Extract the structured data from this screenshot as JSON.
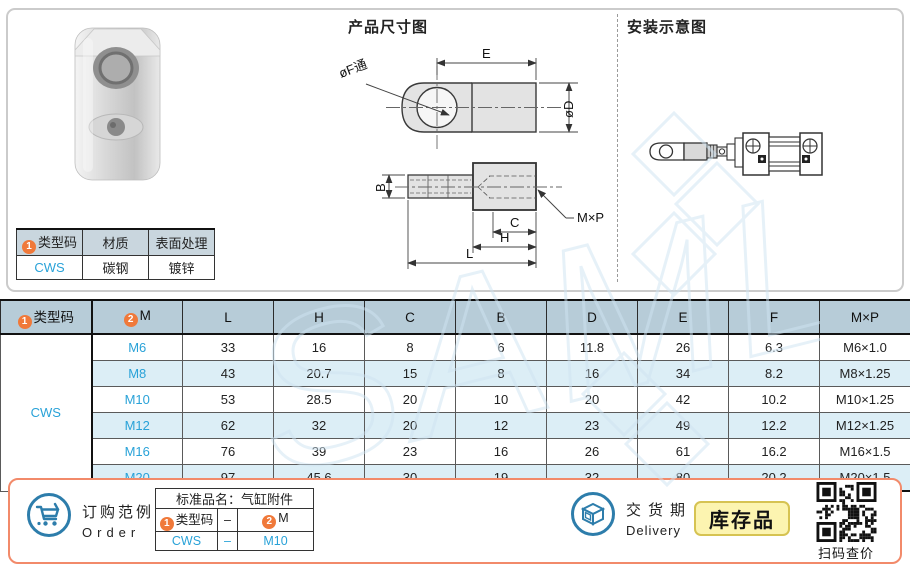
{
  "colors": {
    "accent_blue": "#2d7dab",
    "link_blue": "#29a2d8",
    "header_bg": "#b7ccd8",
    "row_alt_bg": "#dceef6",
    "marker_orange": "#f0793a",
    "panel_border": "#f28a6a",
    "badge_bg": "#fcf4b0",
    "watermark": "#cfe4f2"
  },
  "spec_table": {
    "headers": [
      {
        "marker": "1",
        "label": "类型码"
      },
      {
        "label": "材质"
      },
      {
        "label": "表面处理"
      }
    ],
    "row": [
      "CWS",
      "碳钢",
      "镀锌"
    ]
  },
  "drawings": {
    "dimension_title": "产品尺寸图",
    "install_title": "安装示意图",
    "labels": {
      "E": "E",
      "D": "øD",
      "F": "øF通",
      "B": "B",
      "C": "C",
      "H": "H",
      "L": "L",
      "MxP": "M×P"
    }
  },
  "main_table": {
    "col1_header": {
      "marker": "1",
      "label": "类型码"
    },
    "col2_header": {
      "marker": "2",
      "label": "M"
    },
    "headers": [
      "L",
      "H",
      "C",
      "B",
      "D",
      "E",
      "F",
      "M×P"
    ],
    "type_code": "CWS",
    "rows": [
      {
        "m": "M6",
        "values": [
          "33",
          "16",
          "8",
          "6",
          "11.8",
          "26",
          "6.3",
          "M6×1.0"
        ]
      },
      {
        "m": "M8",
        "values": [
          "43",
          "20.7",
          "15",
          "8",
          "16",
          "34",
          "8.2",
          "M8×1.25"
        ]
      },
      {
        "m": "M10",
        "values": [
          "53",
          "28.5",
          "20",
          "10",
          "20",
          "42",
          "10.2",
          "M10×1.25"
        ]
      },
      {
        "m": "M12",
        "values": [
          "62",
          "32",
          "20",
          "12",
          "23",
          "49",
          "12.2",
          "M12×1.25"
        ]
      },
      {
        "m": "M16",
        "values": [
          "76",
          "39",
          "23",
          "16",
          "26",
          "61",
          "16.2",
          "M16×1.5"
        ]
      },
      {
        "m": "M20",
        "values": [
          "97",
          "45.6",
          "30",
          "19",
          "32",
          "80",
          "20.2",
          "M20×1.5"
        ]
      }
    ]
  },
  "footer": {
    "order": {
      "title_cn": "订购范例",
      "title_en": "Order",
      "table_title": "标准品名：气缸附件",
      "col1": {
        "marker": "1",
        "label": "类型码"
      },
      "dash": "–",
      "col2": {
        "marker": "2",
        "label": "M"
      },
      "row": [
        "CWS",
        "–",
        "M10"
      ]
    },
    "delivery": {
      "title_cn": "交货期",
      "title_en": "Delivery",
      "badge": "库存品",
      "qr_caption": "扫码查价"
    }
  }
}
